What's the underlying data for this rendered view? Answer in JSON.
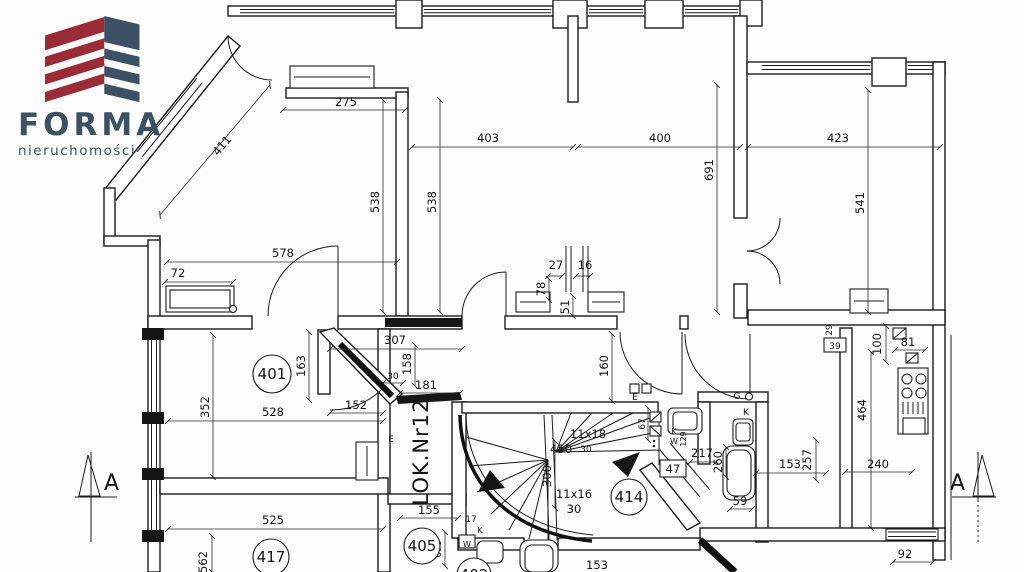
{
  "logo": {
    "brand": "FORMA",
    "subtitle": "nieruchomości",
    "red": "#9b2b35",
    "slate": "#3c5164"
  },
  "plan": {
    "unit_label": "LOK.Nr12",
    "rooms": {
      "r401": "401",
      "r414": "414",
      "r405": "405",
      "r417": "417",
      "r402": "402"
    },
    "dims": {
      "w275": "275",
      "w403": "403",
      "w400": "400",
      "w423": "423",
      "diag411": "411",
      "h691": "691",
      "h538a": "538",
      "h538b": "538",
      "h541": "541",
      "w578": "578",
      "rad72": "72",
      "c27": "27",
      "c16": "16",
      "c78": "78",
      "c51": "51",
      "w307": "307",
      "h163": "163",
      "g30": "30",
      "h158": "158",
      "w181": "181",
      "h352": "352",
      "w528": "528",
      "w152": "152",
      "h160": "160",
      "w217": "217",
      "h260": "260",
      "w153": "153",
      "h257": "257",
      "h464": "464",
      "w240": "240",
      "h100": "100",
      "w81": "81",
      "h29": "29",
      "g17": "17",
      "w155": "155",
      "w525": "525",
      "h562": "562",
      "h698": "698",
      "w59": "59",
      "w153b": "153",
      "w92": "92",
      "h67": "67",
      "t129": "129"
    },
    "stair": {
      "run1": "11x18",
      "land": "450",
      "r1": "30",
      "mid": "300",
      "run2": "11x16",
      "r2": "30"
    },
    "boxed": {
      "b47": "47",
      "b39": "39"
    },
    "meters": {
      "e1": "E",
      "e2": "E",
      "g": "G",
      "k1": "K",
      "k2": "K",
      "k3": "K",
      "w1": "W",
      "w2": "W"
    },
    "section": {
      "left": "A",
      "right": "A"
    }
  }
}
